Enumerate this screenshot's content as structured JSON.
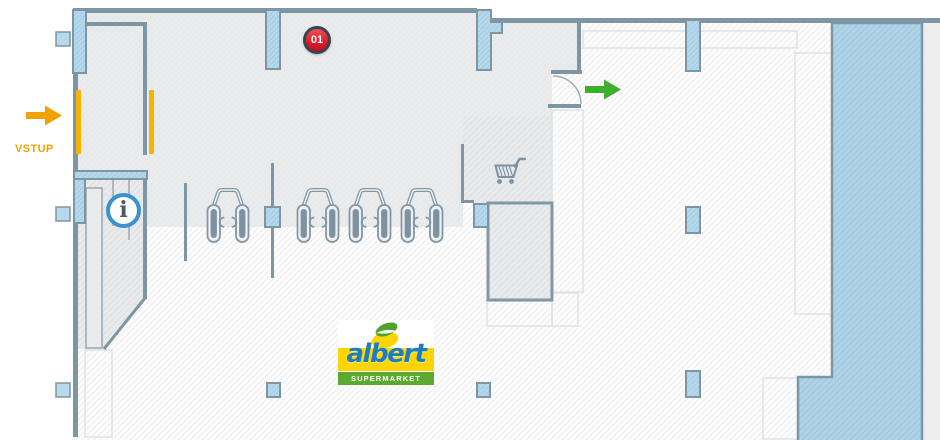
{
  "floorplan": {
    "entrance": {
      "label": "VSTUP",
      "arrow_icon": "arrow-right",
      "accent_color": "#f2a200"
    },
    "exit": {
      "arrow_icon": "arrow-right",
      "accent_color": "#3daf2c"
    },
    "checkout_area": {
      "badge_number": "01",
      "badge_color": "#d61b26",
      "lane_count": 4,
      "lane_icon": "checkout-lane"
    },
    "info_point": {
      "symbol": "i",
      "ring_color": "#3d92cd"
    },
    "cart_zone": {
      "icon": "shopping-cart"
    },
    "logo": {
      "name": "albert",
      "tagline": "SUPERMARKET",
      "colors": {
        "blue": "#1d7dc2",
        "yellow": "#fdd500",
        "green": "#5ca92f"
      }
    },
    "palette": {
      "wall": "#7e95a4",
      "pillar_blue": "#b5d8eb",
      "zone_blue": "#aed3e8",
      "lobby_gray": "#eaebec",
      "outside_gray": "#ededed"
    }
  }
}
